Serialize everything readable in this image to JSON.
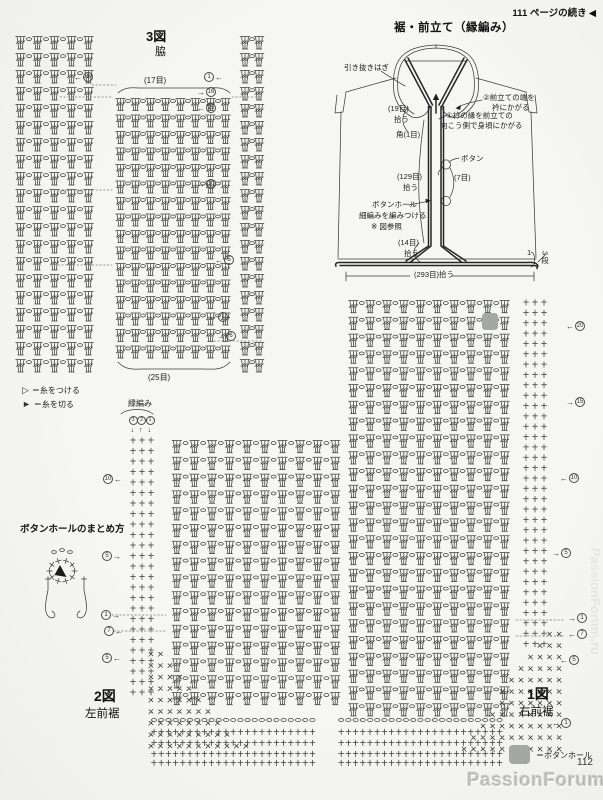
{
  "page": {
    "number": "112",
    "continue_note": "111 ページの続き",
    "continue_arrow": "◀",
    "watermark": "PassionForum.ru",
    "watermark_side": "PassionForum.ru"
  },
  "colors": {
    "ink": "#3c3c3c",
    "ink_dark": "#262626",
    "paper": "#f5f5f2",
    "gray_square": "#a4a7a4"
  },
  "garment": {
    "title": "裾・前立て（縁編み）",
    "labels": [
      {
        "text": "引き抜きはぎ",
        "x": 344,
        "y": 64
      },
      {
        "text": "②前立ての端を",
        "x": 483,
        "y": 94
      },
      {
        "text": "衿にかがる",
        "x": 492,
        "y": 104
      },
      {
        "text": "①衿の縁を前立ての",
        "x": 446,
        "y": 112
      },
      {
        "text": "向こう側で身頃にかがる",
        "x": 440,
        "y": 122
      },
      {
        "text": "(19目)",
        "x": 388,
        "y": 105
      },
      {
        "text": "拾う",
        "x": 394,
        "y": 116
      },
      {
        "text": "角(1目)",
        "x": 396,
        "y": 131
      },
      {
        "text": "ボタン",
        "x": 461,
        "y": 155
      },
      {
        "text": "(129目)",
        "x": 397,
        "y": 173
      },
      {
        "text": "拾う",
        "x": 403,
        "y": 184
      },
      {
        "text": "(7目)",
        "x": 454,
        "y": 174
      },
      {
        "text": "ボタンホール",
        "x": 372,
        "y": 201
      },
      {
        "text": "細編みを編みつける",
        "x": 359,
        "y": 212
      },
      {
        "text": "※ 図参照",
        "x": 371,
        "y": 223
      },
      {
        "text": "(14目)",
        "x": 398,
        "y": 239
      },
      {
        "text": "拾う",
        "x": 404,
        "y": 250
      },
      {
        "text": "(293目)拾う",
        "x": 414,
        "y": 271
      },
      {
        "text": "1",
        "x": 527,
        "y": 249
      },
      {
        "text": "3段",
        "x": 540,
        "y": 251,
        "vertical": true
      }
    ]
  },
  "chart3": {
    "title": "3図",
    "subtitle": "脇",
    "top_count": "(17目)",
    "bottom_count": "(25目)",
    "markers": [
      {
        "num": "1",
        "arrow": "←",
        "arrow_first": true,
        "x": 74,
        "y": 77
      },
      {
        "num": "1",
        "arrow": "←",
        "arrow_first": false,
        "x": 204,
        "y": 77
      },
      {
        "num": "16",
        "arrow": "→",
        "arrow_first": true,
        "x": 197,
        "y": 92
      },
      {
        "num": "15",
        "arrow": "←",
        "arrow_first": true,
        "x": 197,
        "y": 108
      },
      {
        "num": "10",
        "arrow": "→",
        "arrow_first": true,
        "x": 197,
        "y": 184
      },
      {
        "num": "5",
        "arrow": "←",
        "arrow_first": true,
        "x": 215,
        "y": 260
      },
      {
        "num": "1",
        "arrow": "←",
        "arrow_first": true,
        "x": 209,
        "y": 317
      },
      {
        "num": "6",
        "arrow": "→",
        "arrow_first": true,
        "x": 217,
        "y": 336
      }
    ]
  },
  "legend_yarn": {
    "attach_symbol": "▷",
    "attach": "＝糸をつける",
    "cut_symbol": "►",
    "cut": "＝糸を切る"
  },
  "bigchart": {
    "edging_label": "縁編み",
    "edging_steps": [
      "3",
      "2",
      "1"
    ],
    "edging_arrows": [
      "↓",
      "↑",
      "↓"
    ],
    "right_markers": [
      {
        "num": "20",
        "arrow": "←",
        "arrow_first": true,
        "x": 566,
        "y": 326
      },
      {
        "num": "15",
        "arrow": "→",
        "arrow_first": true,
        "x": 566,
        "y": 402
      },
      {
        "num": "10",
        "arrow": "←",
        "arrow_first": true,
        "x": 560,
        "y": 478
      },
      {
        "num": "5",
        "arrow": "→",
        "arrow_first": true,
        "x": 552,
        "y": 553
      },
      {
        "num": "1",
        "arrow": "→",
        "arrow_first": true,
        "x": 568,
        "y": 618
      },
      {
        "num": "7",
        "arrow": "←",
        "arrow_first": true,
        "x": 568,
        "y": 634
      },
      {
        "num": "5",
        "arrow": "←",
        "arrow_first": true,
        "x": 560,
        "y": 660
      },
      {
        "num": "1",
        "arrow": "←",
        "arrow_first": true,
        "x": 552,
        "y": 723
      }
    ],
    "left_markers": [
      {
        "num": "10",
        "arrow": "←",
        "arrow_first": false,
        "x": 103,
        "y": 479
      },
      {
        "num": "5",
        "arrow": "→",
        "arrow_first": false,
        "x": 102,
        "y": 556
      },
      {
        "num": "1",
        "arrow": "→",
        "arrow_first": false,
        "x": 101,
        "y": 615
      },
      {
        "num": "7",
        "arrow": "←",
        "arrow_first": false,
        "x": 104,
        "y": 631
      },
      {
        "num": "5",
        "arrow": "←",
        "arrow_first": false,
        "x": 102,
        "y": 658
      }
    ]
  },
  "fig1": {
    "title": "1図",
    "subtitle": "右前裾"
  },
  "fig2": {
    "title": "2図",
    "subtitle": "左前裾"
  },
  "buttonhole_howto": {
    "title": "ボタンホールのまとめ方"
  },
  "buttonhole_legend": {
    "label": "＝ボタンホール"
  }
}
